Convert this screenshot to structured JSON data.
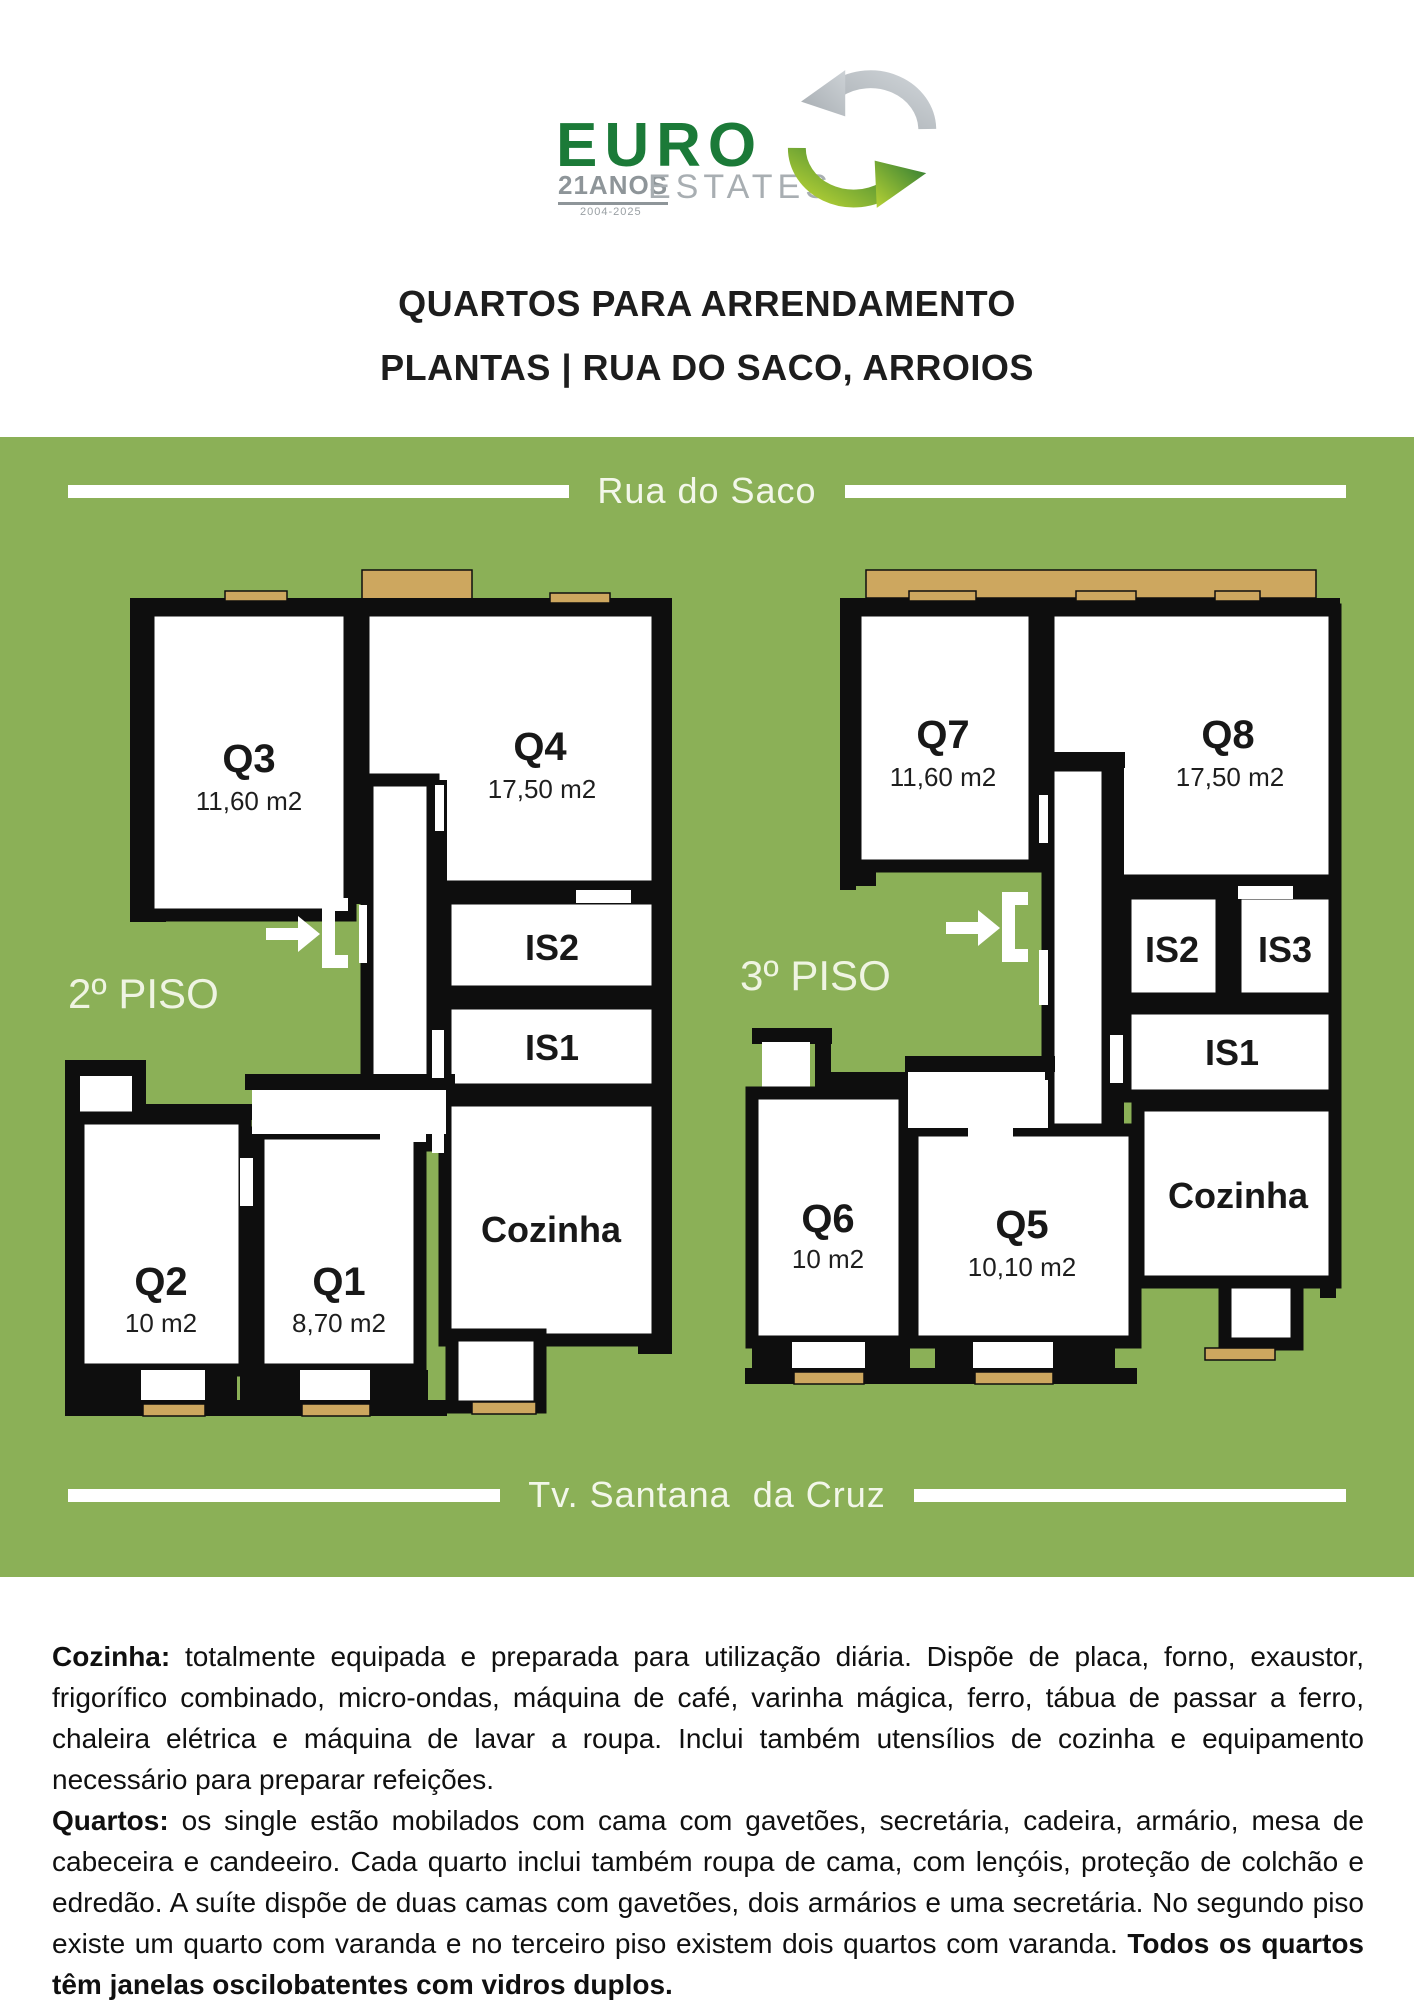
{
  "logo": {
    "brand": "EURO",
    "years": "21ANOS",
    "range": "2004-2025",
    "sub": "ESTATES"
  },
  "title": {
    "line1": "QUARTOS PARA ARRENDAMENTO",
    "line2": "PLANTAS | RUA DO SACO, ARROIOS"
  },
  "streets": {
    "top": "Rua do Saco",
    "bottom": "Tv. Santana  da Cruz"
  },
  "plans": [
    {
      "floor": "2º PISO",
      "rooms": [
        {
          "id": "Q3",
          "area": "11,60 m2"
        },
        {
          "id": "Q4",
          "area": "17,50 m2"
        },
        {
          "id": "IS2",
          "area": ""
        },
        {
          "id": "IS1",
          "area": ""
        },
        {
          "id": "Cozinha",
          "area": ""
        },
        {
          "id": "Q2",
          "area": "10 m2"
        },
        {
          "id": "Q1",
          "area": "8,70 m2"
        }
      ]
    },
    {
      "floor": "3º PISO",
      "rooms": [
        {
          "id": "Q7",
          "area": "11,60 m2"
        },
        {
          "id": "Q8",
          "area": "17,50 m2"
        },
        {
          "id": "IS2",
          "area": ""
        },
        {
          "id": "IS3",
          "area": ""
        },
        {
          "id": "IS1",
          "area": ""
        },
        {
          "id": "Cozinha",
          "area": ""
        },
        {
          "id": "Q6",
          "area": "10 m2"
        },
        {
          "id": "Q5",
          "area": "10,10 m2"
        }
      ]
    }
  ],
  "paragraphs": [
    {
      "label": "Cozinha:",
      "text": "totalmente equipada e preparada para utilização diária. Dispõe de placa, forno, exaustor, frigorífico combinado, micro-ondas, máquina de café, varinha mágica, ferro, tábua de passar a ferro, chaleira elétrica e máquina de lavar a roupa. Inclui também utensílios de cozinha e equipamento necessário para preparar refeições.",
      "bold_tail": ""
    },
    {
      "label": "Quartos:",
      "text": "os single estão mobilados com cama com gavetões, secretária, cadeira, armário, mesa de cabeceira e candeeiro. Cada quarto inclui também roupa de cama, com lençóis, proteção de colchão e edredão. A suíte dispõe de duas camas com gavetões, dois armários e uma secretária. No segundo piso existe um quarto com varanda e no terceiro piso existem dois quartos com varanda.",
      "bold_tail": "Todos os quartos têm janelas oscilobatentes com vidros duplos."
    }
  ],
  "colors": {
    "board_green": "#8BB057",
    "balcony_tan": "#CDA75F",
    "wall_black": "#0e0e0e",
    "logo_green": "#1B7A38",
    "logo_gray": "#A8AEB2"
  }
}
